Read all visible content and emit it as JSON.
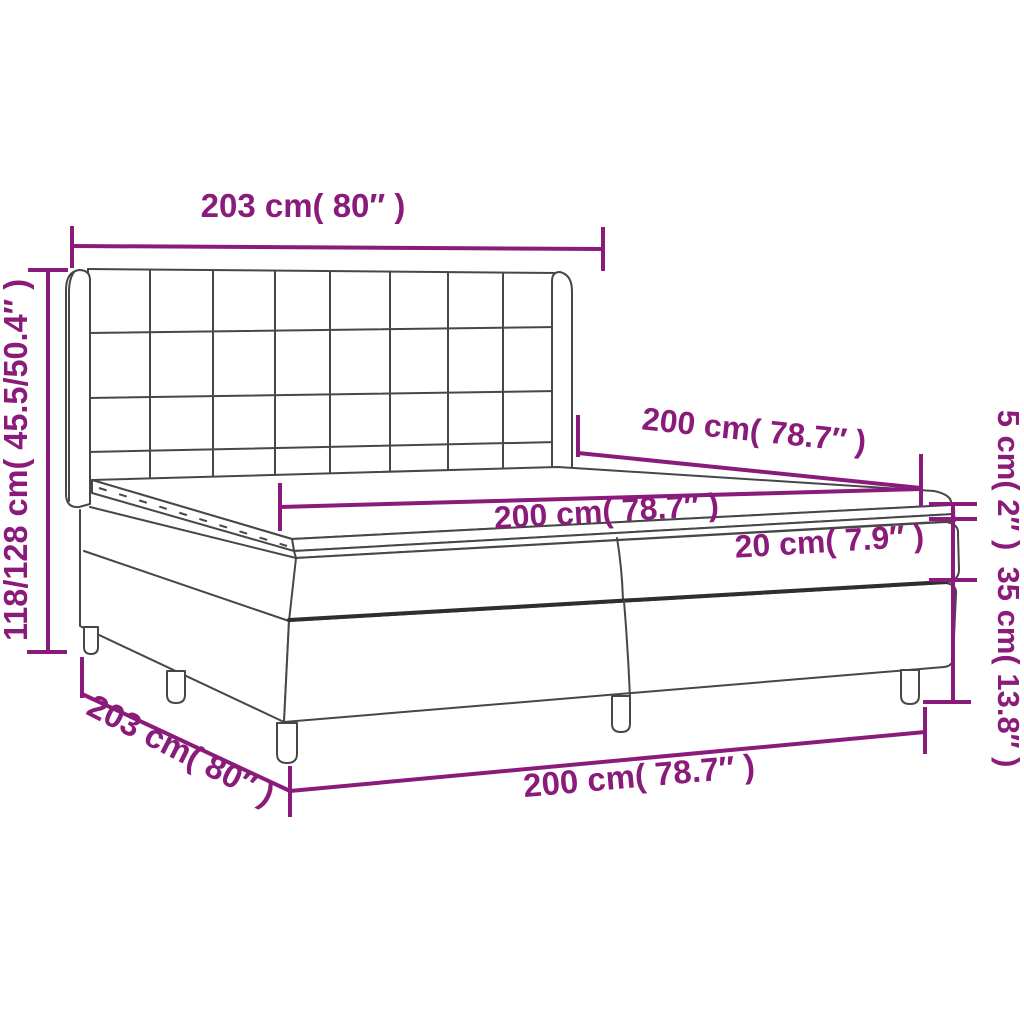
{
  "diagram": {
    "subject": "box-spring-bed-dimension-diagram",
    "colors": {
      "dimension_accent": "#8B1B7A",
      "drawing_outline": "#474747",
      "drawing_outline_dark": "#2E2E2E",
      "background": "#FFFFFF"
    },
    "dimensions": {
      "headboard_width": "203 cm( 80″ )",
      "total_height": "118/128 cm( 45.5/50.4″ )",
      "bed_length_top": "200 cm( 78.7″ )",
      "mattress_length": "200 cm( 78.7″ )",
      "mattress_height": "20 cm( 7.9″ )",
      "topper_height": "5 cm( 2″ )",
      "base_height": "35 cm( 13.8″ )",
      "base_width": "203 cm( 80″ )",
      "base_length": "200 cm( 78.7″ )"
    }
  }
}
